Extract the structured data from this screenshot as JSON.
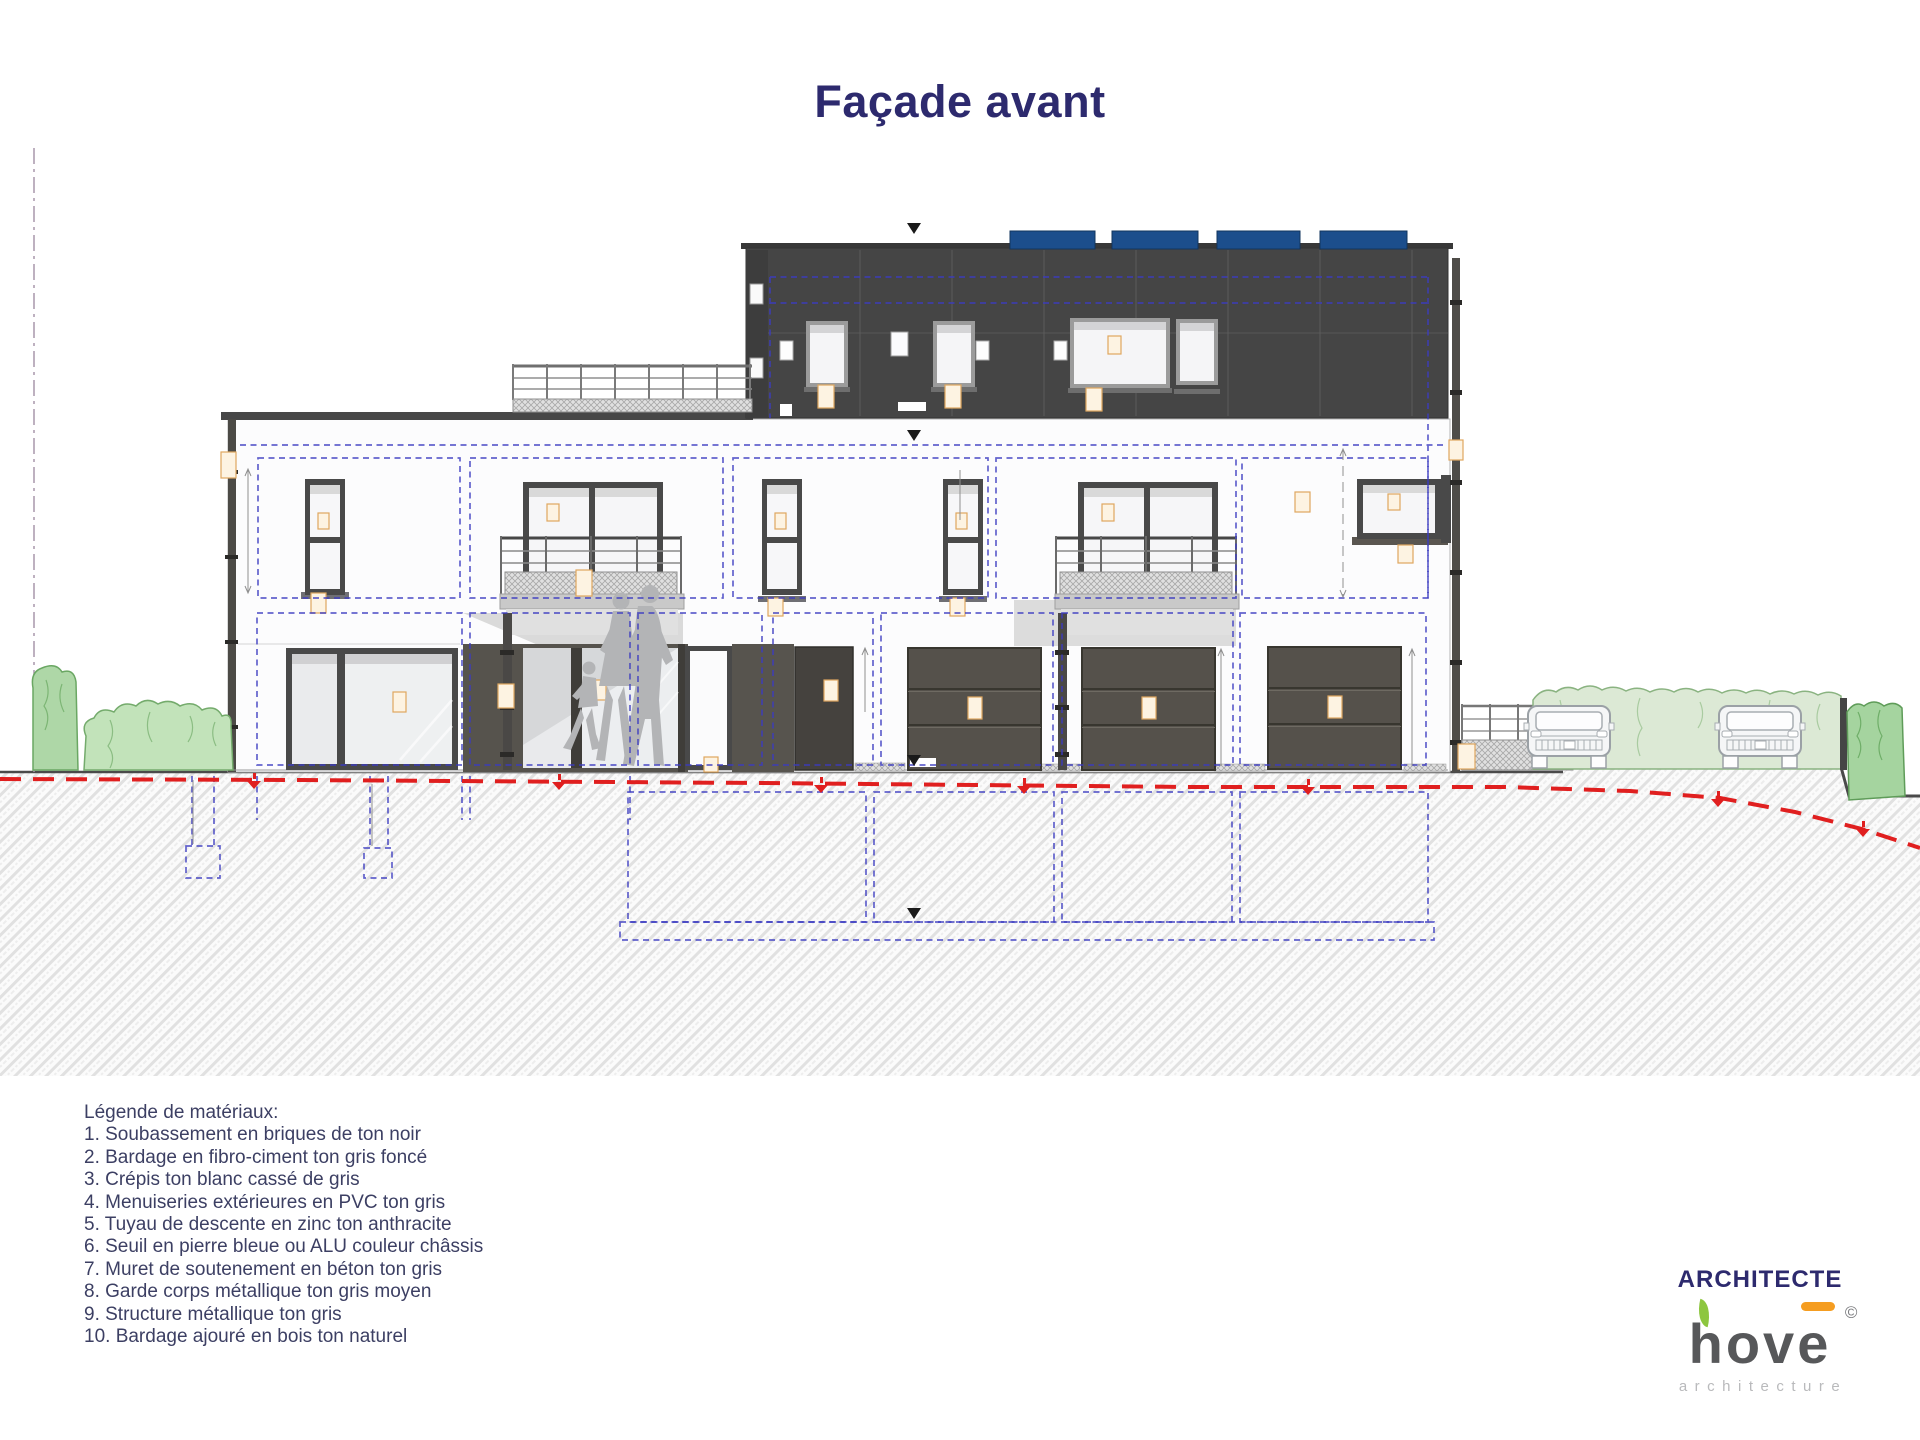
{
  "title": "Façade avant",
  "legend": {
    "heading": "Légende de matériaux:",
    "items": [
      "1. Soubassement en briques de ton noir",
      "2. Bardage en fibro-ciment ton gris foncé",
      "3. Crépis ton blanc cassé de gris",
      "4. Menuiseries extérieures en PVC ton gris",
      "5. Tuyau de descente en zinc ton anthracite",
      "6. Seuil en pierre bleue ou ALU couleur châssis",
      "7. Muret de soutenement en béton ton gris",
      "8. Garde corps métallique ton gris moyen",
      "9. Structure métallique ton gris",
      "10. Bardage ajouré en bois ton naturel"
    ]
  },
  "footer": {
    "architect_label": "ARCHITECTE",
    "logo": {
      "text_base": "hov",
      "text_accent": "e",
      "copyright": "©",
      "subtitle": "architecture"
    }
  },
  "drawing": {
    "view_name": "front-elevation",
    "solar_panels": 4,
    "garage_doors": 3,
    "cars": 2,
    "balconies": 2,
    "people_silhouettes": 3
  },
  "colors": {
    "title_navy": "#2d2a6e",
    "legend_text": "#3c3f63",
    "annotation_blue": "#3b3bc0",
    "grade_red": "#e01f1f",
    "solar_blue": "#1c4e8c",
    "logo_green": "#8dc63f",
    "logo_orange": "#f59d21",
    "logo_gray": "#57585a",
    "logo_light_gray": "#b9babc"
  }
}
